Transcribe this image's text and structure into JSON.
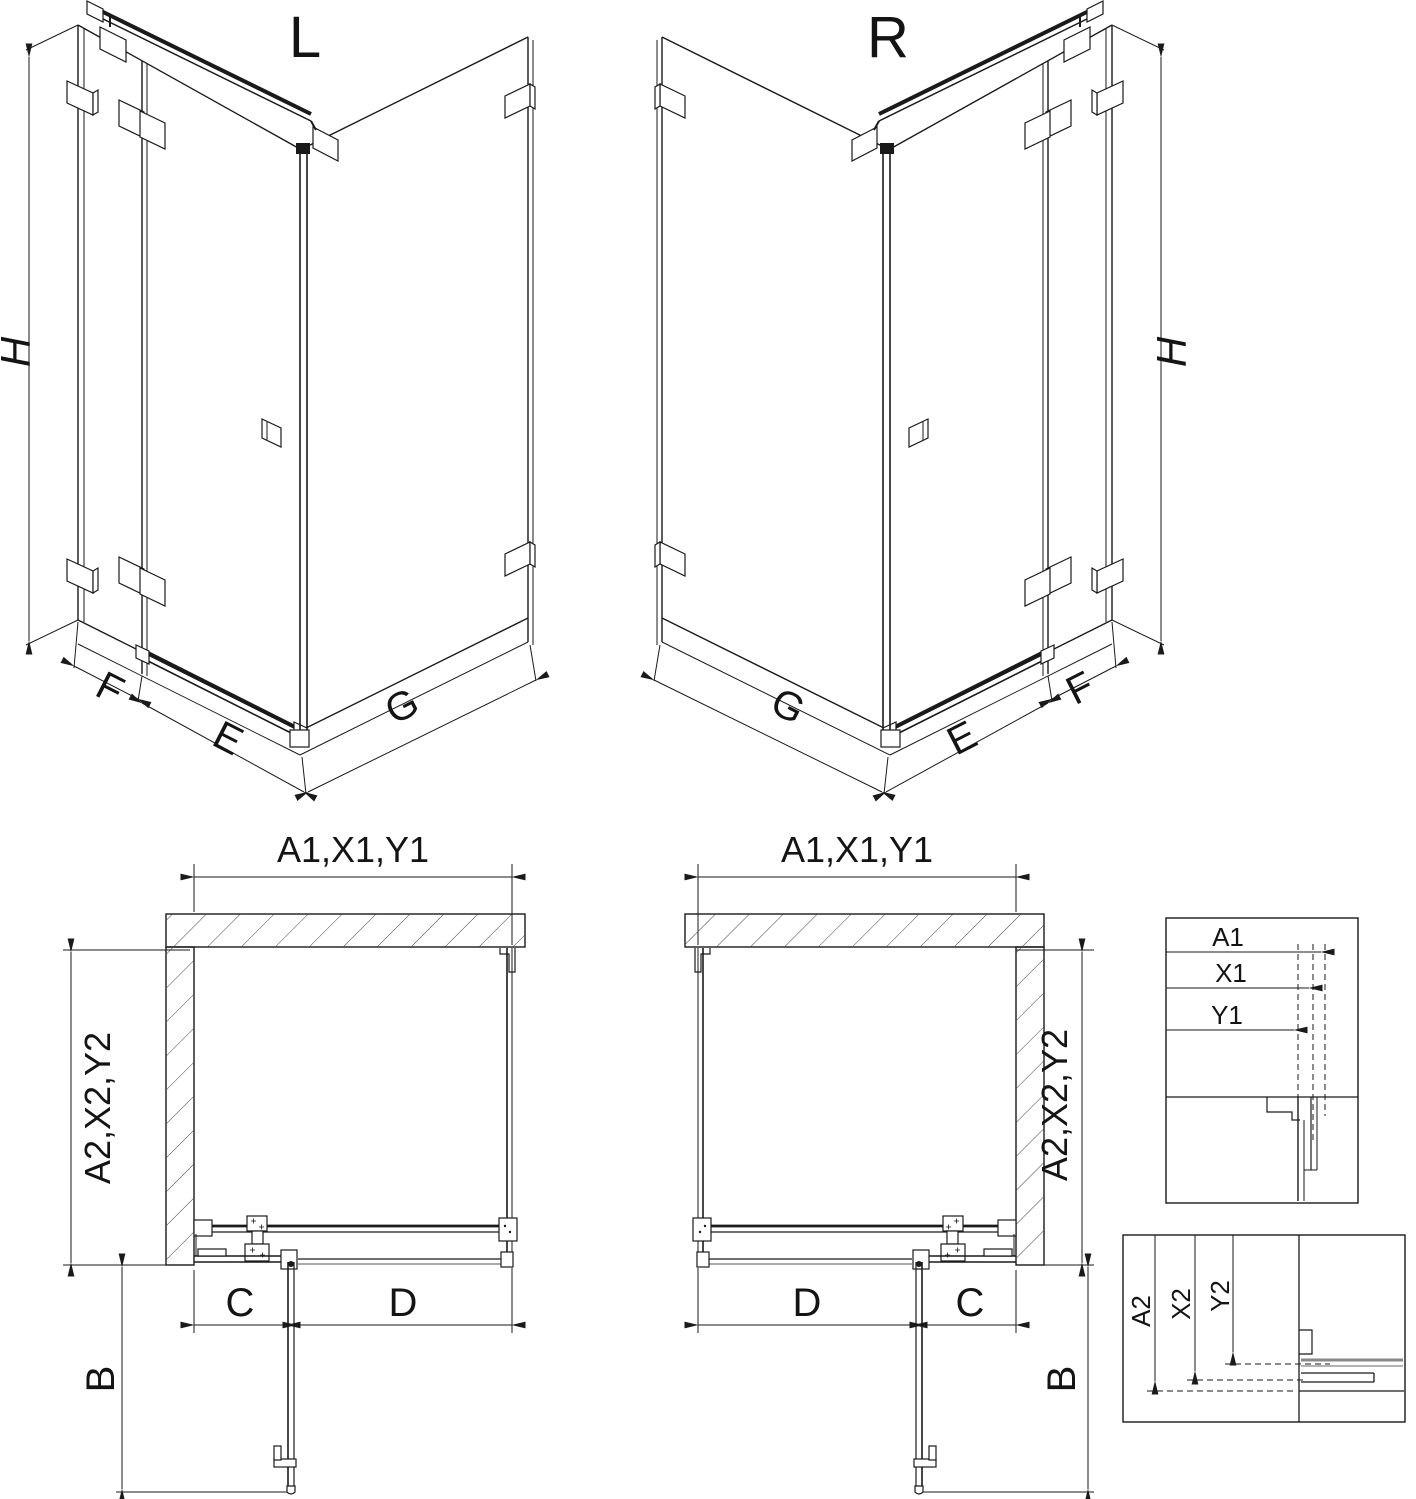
{
  "drawing": {
    "iso_left": {
      "label": "L",
      "dim_height": "H",
      "dim_side_panel": "F",
      "dim_door": "E",
      "dim_return_panel": "G"
    },
    "iso_right": {
      "label": "R",
      "dim_height": "H",
      "dim_side_panel": "F",
      "dim_door": "E",
      "dim_return_panel": "G"
    },
    "plan_left": {
      "dim_top": "A1,X1,Y1",
      "dim_side": "A2,X2,Y2",
      "dim_c": "C",
      "dim_d": "D",
      "dim_door_open": "B"
    },
    "plan_right": {
      "dim_top": "A1,X1,Y1",
      "dim_side": "A2,X2,Y2",
      "dim_c": "C",
      "dim_d": "D",
      "dim_door_open": "B"
    },
    "detail_widths": {
      "dims": [
        "A1",
        "X1",
        "Y1"
      ]
    },
    "detail_depths": {
      "dims": [
        "A2",
        "X2",
        "Y2"
      ]
    }
  },
  "colors": {
    "line": "#1a1a1a",
    "gray": "#888888",
    "background": "#ffffff"
  }
}
